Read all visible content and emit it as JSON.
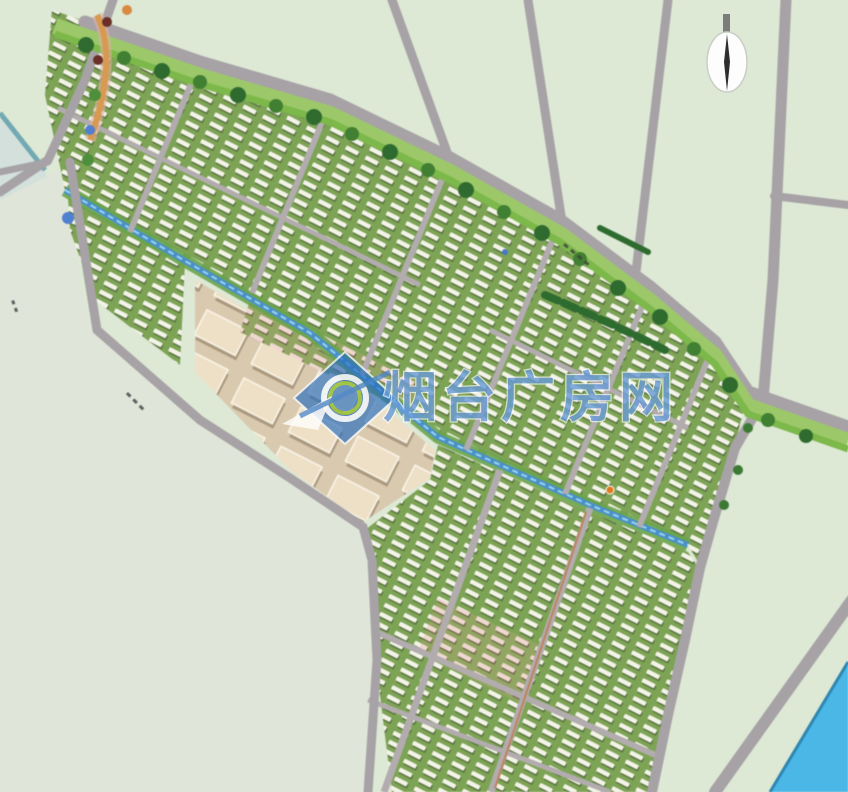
{
  "watermark": {
    "text": "烟台广房网",
    "logo_icon": "compass-diamond-logo-icon"
  },
  "north_arrow": {
    "icon": "north-arrow-icon"
  },
  "map": {
    "type": "master-plan-aerial-rendering",
    "features": {
      "main_road_tree_line": "tree-row-icon",
      "canal": "canal-waterway",
      "river": "river-bottom-right",
      "residential_blocks": "row-housing-blocks",
      "commercial_blocks": "beige-commercial-blocks",
      "open_land": "undeveloped-fields"
    }
  },
  "colors": {
    "field": "#dde8d5",
    "open_land": "#e0e5d9",
    "shore": "#d3e0dc",
    "water": "#4ab7e7",
    "canal": "#4a90c8",
    "grass": "#8cc25e",
    "tree": "#2f6b2f",
    "road": "#a7a2a6",
    "building": "#f3f3e8",
    "commercial": "#eee0c6",
    "block_green": "#7da355",
    "pink_block": "#eed8cf",
    "watermark_blue": "#1f6cc0"
  }
}
